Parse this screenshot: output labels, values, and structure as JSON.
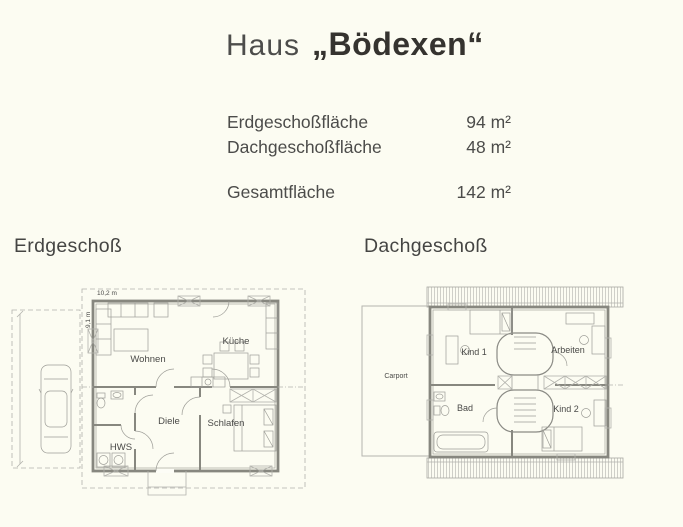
{
  "title": {
    "prefix": "Haus",
    "name": "„Bödexen“"
  },
  "areas": {
    "rows": [
      {
        "label": "Erdgeschoßfläche",
        "value": "94 m²"
      },
      {
        "label": "Dachgeschoßfläche",
        "value": "48 m²"
      }
    ],
    "total": {
      "label": "Gesamtfläche",
      "value": "142 m²"
    }
  },
  "plans": {
    "erdgeschoss": {
      "heading": "Erdgeschoß",
      "dim_width": "10,2 m",
      "dim_height": "9,1 m",
      "rooms": {
        "wohnen": "Wohnen",
        "kueche": "Küche",
        "diele": "Diele",
        "schlafen": "Schlafen",
        "hws": "HWS"
      }
    },
    "dachgeschoss": {
      "heading": "Dachgeschoß",
      "carport": "Carport",
      "rooms": {
        "kind1": "Kind 1",
        "arbeiten": "Arbeiten",
        "bad": "Bad",
        "kind2": "Kind 2"
      }
    }
  },
  "colors": {
    "background": "#fcfcf2",
    "wall": "#87877f",
    "light_line": "#b2b2ac",
    "text": "#474745"
  }
}
